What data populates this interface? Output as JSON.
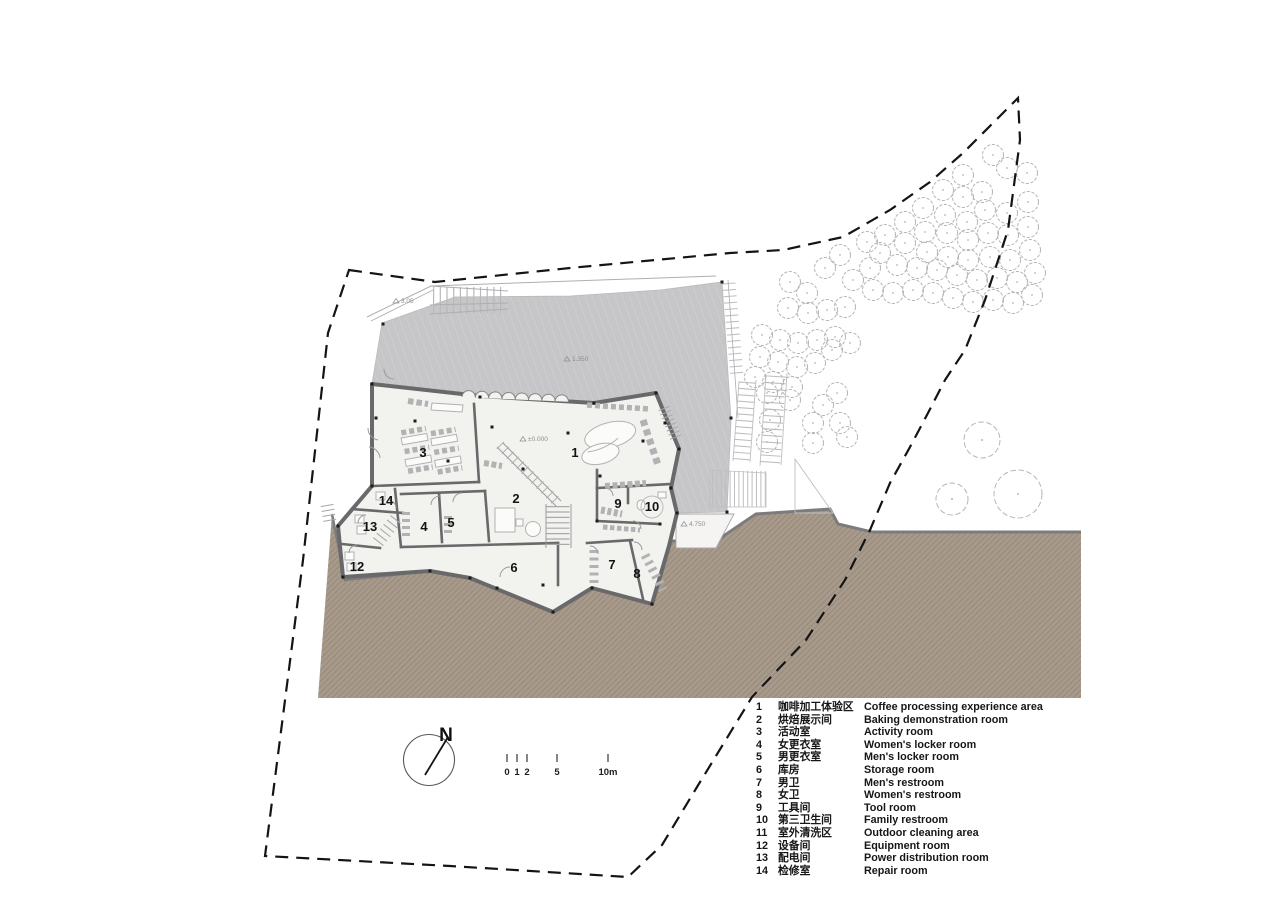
{
  "colors": {
    "terrain": "#a89a8b",
    "terrain_hatch": "#8b7d6e",
    "terrain_border": "#7c7c7e",
    "plaza": "#c6c6c8",
    "plaza_hatch": "#d3d3d5",
    "wall": "#69696b",
    "interior": "#f2f2ef",
    "thin_line": "#9c9c9e",
    "furniture": "#b2b2b4",
    "tree": "#b6b6b8",
    "boundary": "#141414",
    "text": "#161616"
  },
  "legend": {
    "items": [
      {
        "num": "1",
        "zh": "咖啡加工体验区",
        "en": "Coffee processing experience area"
      },
      {
        "num": "2",
        "zh": "烘焙展示间",
        "en": "Baking demonstration room"
      },
      {
        "num": "3",
        "zh": "活动室",
        "en": "Activity room"
      },
      {
        "num": "4",
        "zh": "女更衣室",
        "en": "Women's locker room"
      },
      {
        "num": "5",
        "zh": "男更衣室",
        "en": "Men's locker room"
      },
      {
        "num": "6",
        "zh": "库房",
        "en": "Storage room"
      },
      {
        "num": "7",
        "zh": "男卫",
        "en": "Men's restroom"
      },
      {
        "num": "8",
        "zh": "女卫",
        "en": "Women's restroom"
      },
      {
        "num": "9",
        "zh": "工具间",
        "en": "Tool room"
      },
      {
        "num": "10",
        "zh": "第三卫生间",
        "en": "Family restroom"
      },
      {
        "num": "11",
        "zh": "室外清洗区",
        "en": "Outdoor cleaning area"
      },
      {
        "num": "12",
        "zh": "设备间",
        "en": "Equipment room"
      },
      {
        "num": "13",
        "zh": "配电间",
        "en": "Power distribution room"
      },
      {
        "num": "14",
        "zh": "检修室",
        "en": "Repair room"
      }
    ]
  },
  "plan": {
    "room_labels": [
      {
        "text": "1",
        "x": 575,
        "y": 457
      },
      {
        "text": "2",
        "x": 516,
        "y": 503
      },
      {
        "text": "3",
        "x": 423,
        "y": 457
      },
      {
        "text": "4",
        "x": 424,
        "y": 531
      },
      {
        "text": "5",
        "x": 451,
        "y": 527
      },
      {
        "text": "6",
        "x": 514,
        "y": 572
      },
      {
        "text": "7",
        "x": 612,
        "y": 569
      },
      {
        "text": "8",
        "x": 637,
        "y": 578
      },
      {
        "text": "9",
        "x": 618,
        "y": 508
      },
      {
        "text": "10",
        "x": 652,
        "y": 511
      },
      {
        "text": "12",
        "x": 357,
        "y": 571
      },
      {
        "text": "13",
        "x": 370,
        "y": 531
      },
      {
        "text": "14",
        "x": 386,
        "y": 505
      }
    ],
    "level_annotations": [
      {
        "text": "±0.000",
        "x": 530,
        "y": 441
      },
      {
        "text": "4.750",
        "x": 691,
        "y": 526
      },
      {
        "text": "3.05",
        "x": 403,
        "y": 303
      },
      {
        "text": "1.350",
        "x": 574,
        "y": 361
      }
    ],
    "column_dots": [
      [
        372,
        384
      ],
      [
        480,
        397
      ],
      [
        594,
        403
      ],
      [
        656,
        393
      ],
      [
        679,
        449
      ],
      [
        671,
        488
      ],
      [
        677,
        513
      ],
      [
        652,
        604
      ],
      [
        592,
        588
      ],
      [
        553,
        612
      ],
      [
        470,
        578
      ],
      [
        430,
        571
      ],
      [
        343,
        577
      ],
      [
        338,
        526
      ],
      [
        372,
        486
      ],
      [
        376,
        418
      ],
      [
        415,
        421
      ],
      [
        448,
        461
      ],
      [
        492,
        427
      ],
      [
        523,
        469
      ],
      [
        568,
        433
      ],
      [
        600,
        476
      ],
      [
        643,
        441
      ],
      [
        665,
        423
      ],
      [
        497,
        588
      ],
      [
        543,
        585
      ],
      [
        383,
        324
      ],
      [
        722,
        282
      ],
      [
        731,
        418
      ],
      [
        727,
        512
      ],
      [
        660,
        524
      ],
      [
        597,
        521
      ]
    ]
  },
  "site": {
    "trees": {
      "small": [
        [
          993,
          155
        ],
        [
          1007,
          168
        ],
        [
          963,
          175
        ],
        [
          982,
          192
        ],
        [
          1027,
          173
        ],
        [
          943,
          190
        ],
        [
          963,
          197
        ],
        [
          985,
          210
        ],
        [
          1007,
          213
        ],
        [
          1028,
          202
        ],
        [
          923,
          208
        ],
        [
          945,
          215
        ],
        [
          967,
          222
        ],
        [
          905,
          222
        ],
        [
          925,
          232
        ],
        [
          947,
          233
        ],
        [
          968,
          240
        ],
        [
          988,
          233
        ],
        [
          1008,
          235
        ],
        [
          1028,
          227
        ],
        [
          885,
          235
        ],
        [
          867,
          242
        ],
        [
          905,
          243
        ],
        [
          927,
          252
        ],
        [
          948,
          257
        ],
        [
          968,
          260
        ],
        [
          990,
          257
        ],
        [
          1010,
          260
        ],
        [
          1030,
          250
        ],
        [
          880,
          253
        ],
        [
          897,
          265
        ],
        [
          917,
          268
        ],
        [
          937,
          270
        ],
        [
          957,
          275
        ],
        [
          977,
          280
        ],
        [
          997,
          278
        ],
        [
          1017,
          282
        ],
        [
          1035,
          273
        ],
        [
          870,
          268
        ],
        [
          853,
          280
        ],
        [
          873,
          290
        ],
        [
          893,
          293
        ],
        [
          913,
          290
        ],
        [
          933,
          293
        ],
        [
          953,
          298
        ],
        [
          973,
          302
        ],
        [
          993,
          300
        ],
        [
          1013,
          303
        ],
        [
          1032,
          295
        ],
        [
          840,
          255
        ],
        [
          825,
          268
        ],
        [
          807,
          293
        ],
        [
          790,
          282
        ],
        [
          788,
          308
        ],
        [
          808,
          313
        ],
        [
          827,
          310
        ],
        [
          845,
          307
        ],
        [
          762,
          335
        ],
        [
          780,
          340
        ],
        [
          798,
          343
        ],
        [
          817,
          340
        ],
        [
          835,
          337
        ],
        [
          850,
          343
        ],
        [
          832,
          350
        ],
        [
          760,
          357
        ],
        [
          778,
          362
        ],
        [
          797,
          367
        ],
        [
          815,
          363
        ],
        [
          755,
          377
        ],
        [
          773,
          382
        ],
        [
          792,
          387
        ],
        [
          767,
          393
        ],
        [
          790,
          400
        ],
        [
          813,
          423
        ],
        [
          823,
          405
        ],
        [
          837,
          393
        ],
        [
          840,
          423
        ],
        [
          847,
          437
        ],
        [
          770,
          420
        ],
        [
          767,
          442
        ],
        [
          813,
          443
        ]
      ],
      "large": [
        [
          982,
          440,
          18
        ],
        [
          952,
          499,
          16
        ],
        [
          1018,
          494,
          24
        ]
      ]
    }
  },
  "compass": {
    "label": "N"
  },
  "scale_bar": {
    "ticks": [
      {
        "label": "0",
        "x": 507
      },
      {
        "label": "1",
        "x": 517
      },
      {
        "label": "2",
        "x": 527
      },
      {
        "label": "5",
        "x": 557
      },
      {
        "label": "10m",
        "x": 608
      }
    ]
  }
}
